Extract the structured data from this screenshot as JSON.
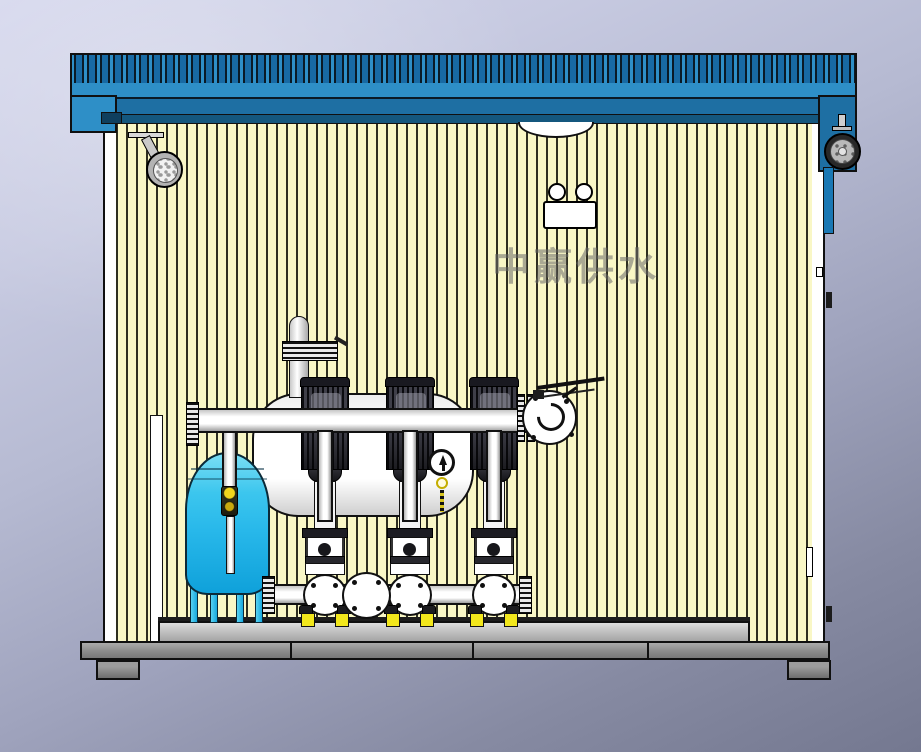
{
  "watermark": {
    "text": "中赢供水"
  },
  "palette": {
    "roof_blue": "#2e8fc7",
    "roof_dark": "#1e6fa3",
    "eave_dark": "#14577e",
    "wall_yellow": "#f9f7c6",
    "wall_stripe": "#2e2e20",
    "tank_cyan_light": "#7adef4",
    "tank_cyan": "#28b8ea",
    "tank_cyan_deep": "#0fa1da",
    "cabinet_blue": "#1a78b4",
    "damper_yellow": "#f2e71c",
    "platform_grey": "#c2c2c2",
    "base_grey": "#8e8e8e",
    "background_top": "#d4d6ec",
    "background_bottom": "#747890"
  },
  "equipment": {
    "pump_count": 3,
    "pump_centers_x": [
      325,
      410,
      494
    ],
    "components": [
      "corrugated-blue-roof",
      "yellow-striped-wall-panels",
      "ceiling-spotlight",
      "vent-arch",
      "dual-indicator-box",
      "exhaust-fan",
      "control-cabinet",
      "door-handle",
      "door-hinge",
      "diaphragm-pressure-tank",
      "stabilized-flow-tank",
      "discharge-manifold",
      "suction-manifold",
      "vertical-multistage-pump",
      "butterfly-valve",
      "pressure-gauge",
      "air-release-valve",
      "steel-base-frame",
      "vibration-dampers"
    ]
  }
}
